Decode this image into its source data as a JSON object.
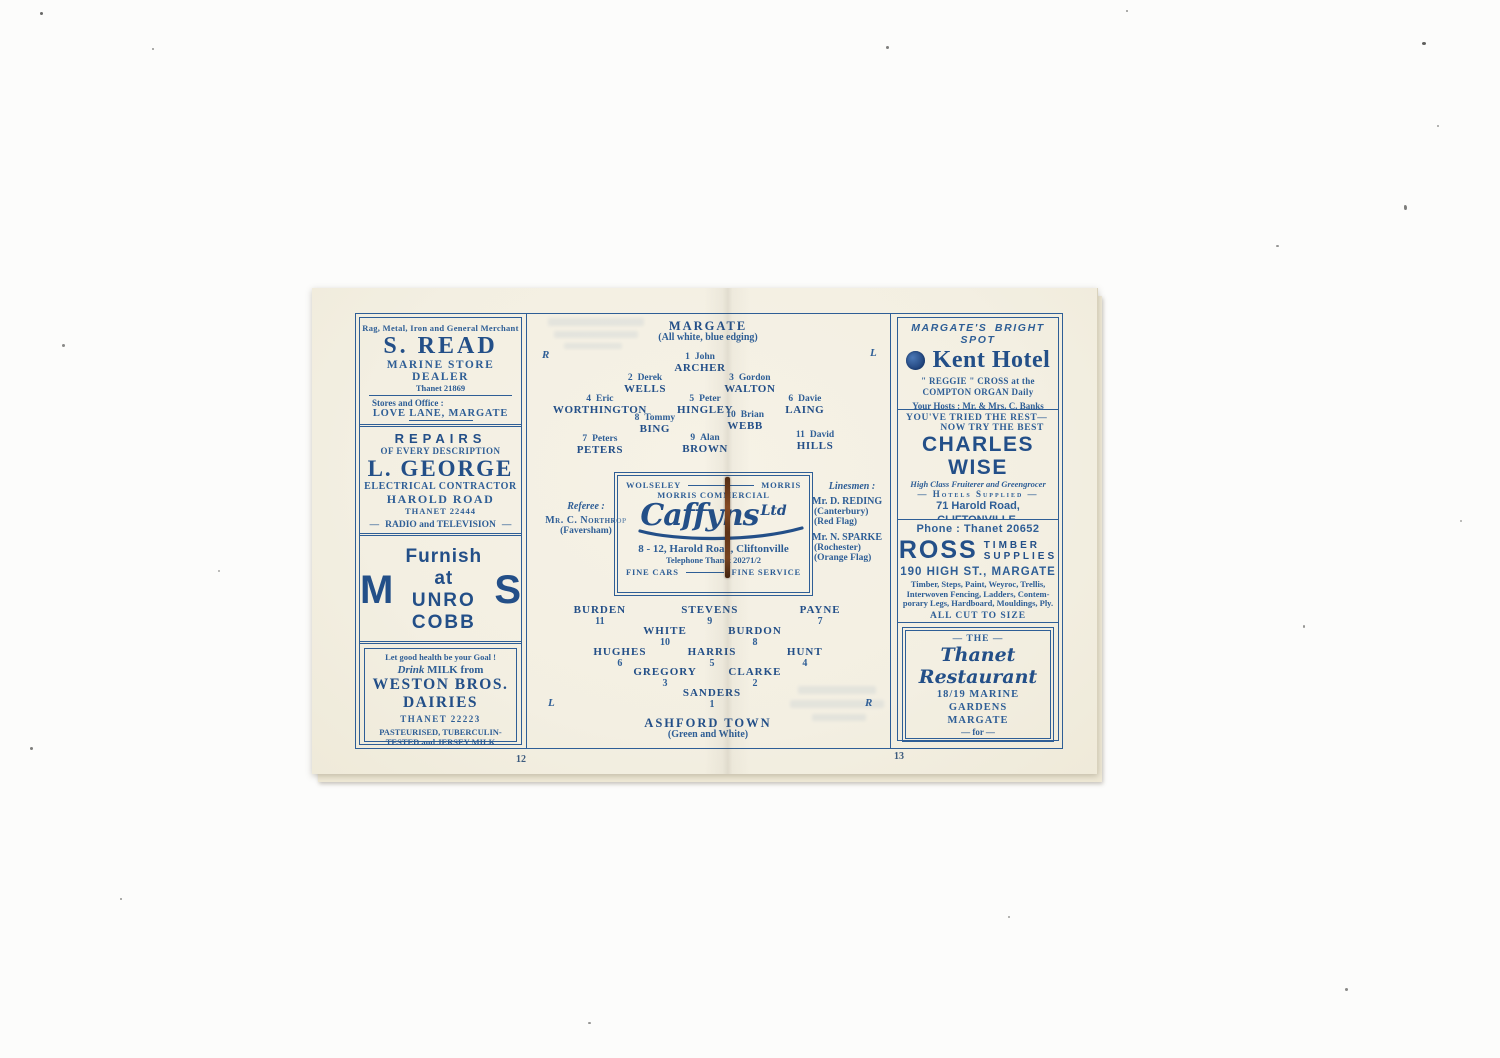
{
  "meta": {
    "ink_color": "#2e5e96",
    "paper_color": "#f3efe2",
    "staple_color": "#6b3a1e"
  },
  "pages": {
    "left_number": "12",
    "right_number": "13"
  },
  "left_ads": {
    "s_read": {
      "tagline": "Rag, Metal, Iron and General Merchant",
      "name": "S. READ",
      "subtitle": "MARINE STORE DEALER",
      "phone": "Thanet 21869",
      "stores_label": "Stores and Office :",
      "address": "LOVE LANE, MARGATE",
      "services": "Wipers Supplied  :  Warehouses Cleared"
    },
    "george": {
      "heading": "REPAIRS",
      "subheading": "OF EVERY DESCRIPTION",
      "name": "L. GEORGE",
      "role": "ELECTRICAL CONTRACTOR",
      "address": "HAROLD ROAD",
      "phone": "THANET 22444",
      "footer": "RADIO and TELEVISION"
    },
    "munro": {
      "big_m": "M",
      "line1": "Furnish at",
      "line2": "UNRO COBB",
      "big_s": "S",
      "address": "223/9 Northdown Road,",
      "town": "CLIFTONVILLE"
    },
    "weston": {
      "tagline": "Let good health be your Goal !",
      "drink_word": "Drink",
      "drink_rest": " MILK from",
      "name1": "WESTON BROS.",
      "name2": "DAIRIES",
      "phone": "THANET  22223",
      "footer1": "PASTEURISED, TUBERCULIN-",
      "footer2": "TESTED and JERSEY MILK"
    }
  },
  "center": {
    "margate": {
      "title": "MARGATE",
      "kit": "(All white, blue edging)",
      "right_label": "R",
      "left_label": "L",
      "players": [
        {
          "num": "1",
          "first": "John",
          "last": "ARCHER"
        },
        {
          "num": "2",
          "first": "Derek",
          "last": "WELLS"
        },
        {
          "num": "3",
          "first": "Gordon",
          "last": "WALTON"
        },
        {
          "num": "4",
          "first": "Eric",
          "last": "WORTHINGTON"
        },
        {
          "num": "5",
          "first": "Peter",
          "last": "HINGLEY"
        },
        {
          "num": "6",
          "first": "Davie",
          "last": "LAING"
        },
        {
          "num": "8",
          "first": "Tommy",
          "last": "BING"
        },
        {
          "num": "10",
          "first": "Brian",
          "last": "WEBB"
        },
        {
          "num": "7",
          "first": "Peters",
          "last": "PETERS"
        },
        {
          "num": "9",
          "first": "Alan",
          "last": "BROWN"
        },
        {
          "num": "11",
          "first": "David",
          "last": "HILLS"
        }
      ]
    },
    "officials": {
      "referee_label": "Referee :",
      "referee_name": "Mr. C. Northrop",
      "referee_town": "(Faversham)",
      "linesmen_label": "Linesmen :",
      "linesman1_name": "Mr. D. REDING",
      "linesman1_town": "(Canterbury)",
      "linesman1_flag": "(Red Flag)",
      "linesman2_name": "Mr. N. SPARKE",
      "linesman2_town": "(Rochester)",
      "linesman2_flag": "(Orange Flag)"
    },
    "caffyns": {
      "brand_left": "WOLSELEY",
      "brand_right": "MORRIS",
      "brand_center": "MORRIS COMMERCIAL",
      "logo": "Caffyns",
      "logo_suffix": "Ltd",
      "address": "8 - 12, Harold Road, Cliftonville",
      "phone": "Telephone Thanet 20271/2",
      "foot_left": "FINE CARS",
      "foot_right": "FINE SERVICE"
    },
    "ashford": {
      "title": "ASHFORD TOWN",
      "kit": "(Green and White)",
      "left_label": "L",
      "right_label": "R",
      "players": [
        {
          "num": "11",
          "last": "BURDEN"
        },
        {
          "num": "9",
          "last": "STEVENS"
        },
        {
          "num": "7",
          "last": "PAYNE"
        },
        {
          "num": "10",
          "last": "WHITE"
        },
        {
          "num": "8",
          "last": "BURDON"
        },
        {
          "num": "6",
          "last": "HUGHES"
        },
        {
          "num": "5",
          "last": "HARRIS"
        },
        {
          "num": "4",
          "last": "HUNT"
        },
        {
          "num": "3",
          "last": "GREGORY"
        },
        {
          "num": "2",
          "last": "CLARKE"
        },
        {
          "num": "1",
          "last": "SANDERS"
        }
      ]
    }
  },
  "right_ads": {
    "kent": {
      "tagline": "MARGATE'S BRIGHT SPOT",
      "name": "Kent Hotel",
      "line1": "\" REGGIE \" CROSS at the",
      "line2": "COMPTON ORGAN Daily",
      "hosts": "Your Hosts :  Mr. & Mrs. C. Banks",
      "beers": "Charrington's London Beers"
    },
    "wise": {
      "tried1": "YOU'VE  TRIED  THE  REST—",
      "tried2": "NOW TRY THE BEST",
      "name": "CHARLES WISE",
      "subtitle": "High Class Fruiterer and Greengrocer",
      "hotels": "— Hotels Supplied —",
      "address": "71 Harold Road, CLIFTONVILLE,",
      "town": "MARGATE",
      "sep": "::",
      "phone": "Thanet 22000"
    },
    "ross": {
      "phone": "Phone :  Thanet 20652",
      "name": "ROSS",
      "stack1": "TIMBER",
      "stack2": "SUPPLIES",
      "address": "190 HIGH ST., MARGATE",
      "lines": [
        "Timber, Steps, Paint, Weyroc, Trellis,",
        "Interwoven Fencing, Ladders, Contem-",
        "porary Legs, Hardboard, Mouldings, Ply."
      ],
      "cut": "ALL CUT TO SIZE",
      "footer": "For all your \" Do it yourself \" materials."
    },
    "thanet": {
      "the": "—  THE  —",
      "name": "Thanet Restaurant",
      "address1": "18/19  MARINE  GARDENS",
      "address2": "MARGATE",
      "for_word": "—  for  —",
      "meals": "LUNCHEONS  ::  TEAS  ::  DINNERS",
      "licensed": "FULLY LICENSED"
    }
  }
}
